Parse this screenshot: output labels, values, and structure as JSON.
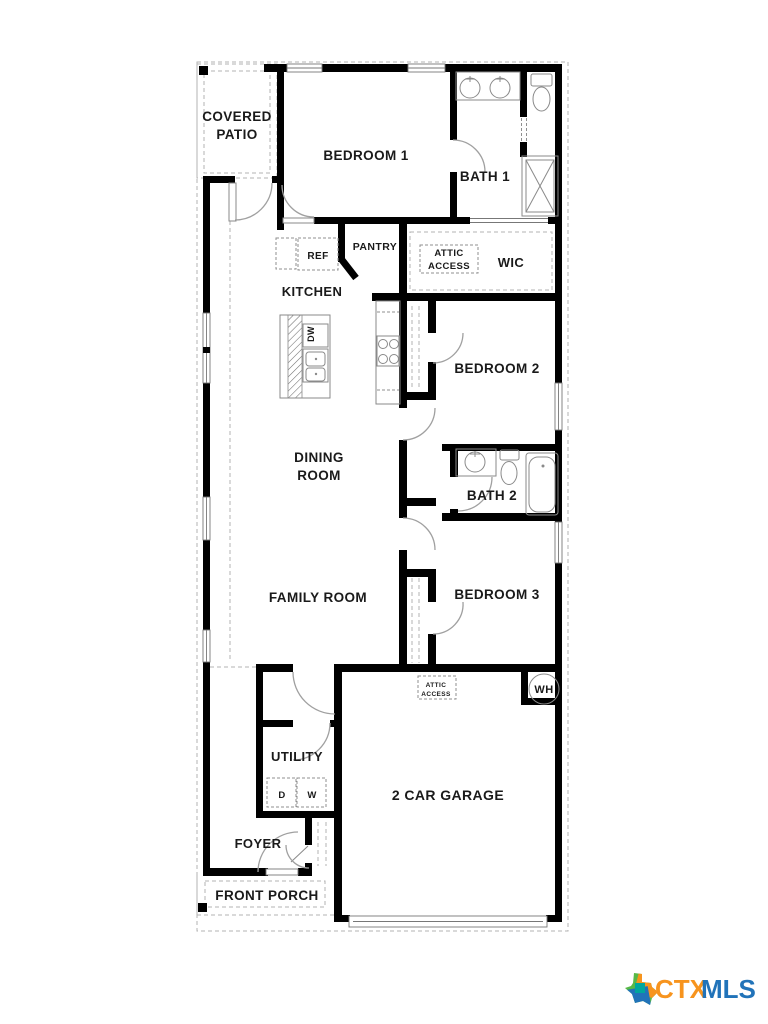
{
  "plan": {
    "labels": {
      "covered_patio_1": "COVERED",
      "covered_patio_2": "PATIO",
      "bedroom1": "BEDROOM 1",
      "bath1": "BATH 1",
      "ref": "REF",
      "pantry": "PANTRY",
      "attic1_1": "ATTIC",
      "attic1_2": "ACCESS",
      "wic": "WIC",
      "kitchen": "KITCHEN",
      "dw": "DW",
      "bedroom2": "BEDROOM 2",
      "dining_1": "DINING",
      "dining_2": "ROOM",
      "bath2": "BATH 2",
      "family_room": "FAMILY ROOM",
      "bedroom3": "BEDROOM 3",
      "attic2_1": "ATTIC",
      "attic2_2": "ACCESS",
      "wh": "WH",
      "utility": "UTILITY",
      "dryer": "D",
      "washer": "W",
      "garage": "2 CAR GARAGE",
      "foyer": "FOYER",
      "front_porch": "FRONT PORCH"
    }
  },
  "logo": {
    "ctx": "CTX",
    "mls": "MLS"
  },
  "colors": {
    "wall": "#000000",
    "fixture_line": "#8a8a8a",
    "dash_line": "#b3b3b3",
    "label": "#1a1a1a",
    "logo_ctx": "#F7941E",
    "logo_mls": "#2173B9",
    "logo_green": "#58B947",
    "logo_teal": "#00A79D",
    "logo_blue": "#2173B9"
  }
}
